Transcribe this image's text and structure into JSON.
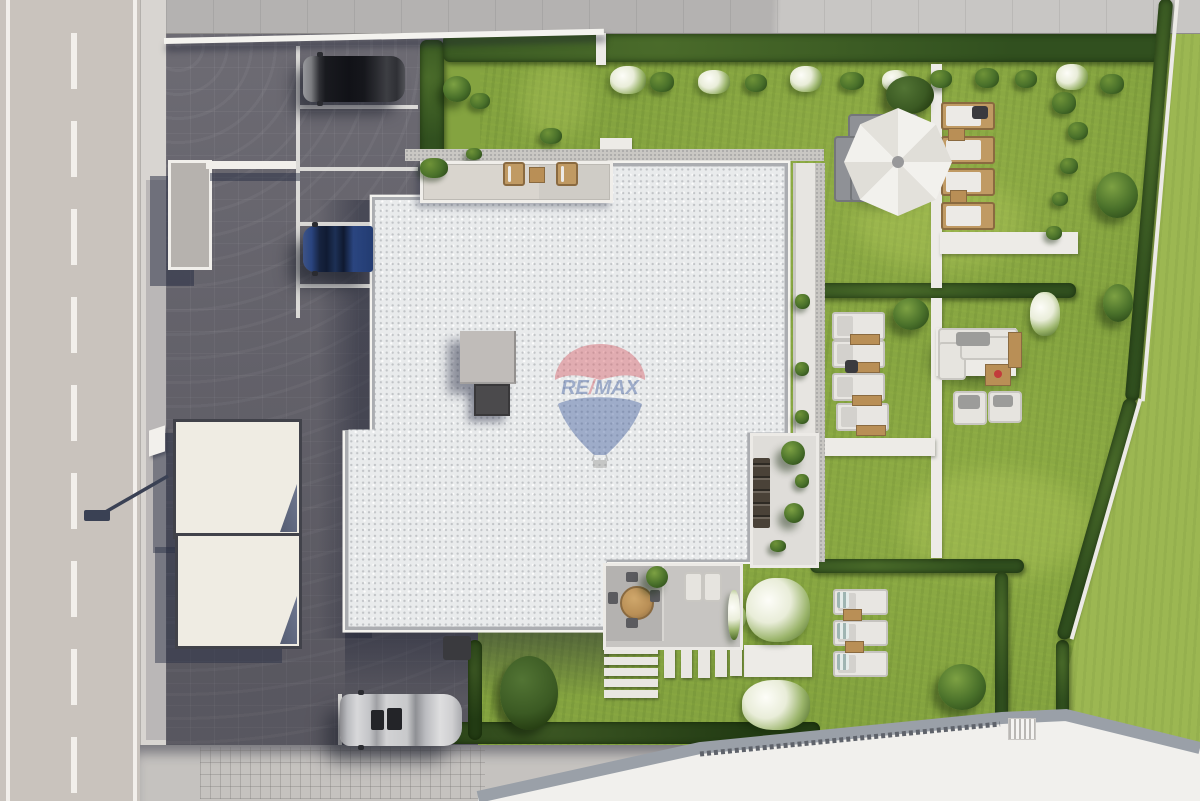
{
  "logo": {
    "re": "RE",
    "slash": "/",
    "max": "MAX"
  },
  "palette": {
    "grass": "#84a340",
    "grassLight": "#9cb752",
    "road": "#c9c3bd",
    "line": "#f2efeb",
    "sidewalk": "#d8d5d1",
    "paver": "#74727a",
    "roofWhite": "#e9ebec",
    "roofBorder": "#abadb1",
    "roofRail": "#f4f3ef",
    "hedge": "#31501f",
    "tree": "#49702a",
    "path": "#edebe7",
    "wood": "#b98f56",
    "woodLight": "#c09a63",
    "furnWhite": "#e8e6e2",
    "sofaGray": "#8f9196",
    "logoRed": "#d9626b",
    "logoBlue": "#44609f",
    "carDark": "#1a1b20",
    "carBlue": "#27477f",
    "carSilver": "#c9c9cc"
  },
  "scene": {
    "ground": [
      {
        "t": "road-dash",
        "x": 71,
        "y": 33,
        "w": 6,
        "h": 56
      },
      {
        "t": "road-dash",
        "x": 71,
        "y": 121,
        "w": 6,
        "h": 56
      },
      {
        "t": "road-dash",
        "x": 71,
        "y": 209,
        "w": 6,
        "h": 56
      },
      {
        "t": "road-dash",
        "x": 71,
        "y": 297,
        "w": 6,
        "h": 56
      },
      {
        "t": "road-dash",
        "x": 71,
        "y": 385,
        "w": 6,
        "h": 56
      },
      {
        "t": "road-dash",
        "x": 71,
        "y": 473,
        "w": 6,
        "h": 56
      },
      {
        "t": "road-dash",
        "x": 71,
        "y": 561,
        "w": 6,
        "h": 56
      },
      {
        "t": "road-dash",
        "x": 71,
        "y": 649,
        "w": 6,
        "h": 56
      },
      {
        "t": "road-dash",
        "x": 71,
        "y": 737,
        "w": 6,
        "h": 56
      },
      {
        "t": "pline",
        "x": 296,
        "y": 46,
        "w": 4,
        "h": 272
      },
      {
        "t": "pline",
        "x": 300,
        "y": 105,
        "w": 118,
        "h": 4
      },
      {
        "t": "pline",
        "x": 300,
        "y": 167,
        "w": 118,
        "h": 4
      },
      {
        "t": "pline",
        "x": 300,
        "y": 222,
        "w": 118,
        "h": 4
      },
      {
        "t": "pline",
        "x": 300,
        "y": 284,
        "w": 118,
        "h": 4
      },
      {
        "t": "pline",
        "x": 338,
        "y": 694,
        "w": 4,
        "h": 60
      },
      {
        "t": "pline",
        "x": 342,
        "y": 752,
        "w": 118,
        "h": 4
      },
      {
        "t": "grass-patch",
        "x": 444,
        "y": 33,
        "w": 36,
        "h": 128
      },
      {
        "t": "grass-light",
        "x": 855,
        "y": 175,
        "w": 170,
        "h": 95
      },
      {
        "t": "grass-light",
        "x": 900,
        "y": 470,
        "w": 190,
        "h": 110
      },
      {
        "t": "grass-light",
        "x": 520,
        "y": 60,
        "w": 70,
        "h": 80
      },
      {
        "t": "shade",
        "x": 844,
        "y": 140,
        "w": 86,
        "h": 68
      },
      {
        "t": "shade",
        "x": 930,
        "y": 336,
        "w": 90,
        "h": 50
      },
      {
        "t": "hedge",
        "x": 420,
        "y": 40,
        "w": 24,
        "h": 124
      },
      {
        "t": "hedge",
        "x": 443,
        "y": 34,
        "w": 720,
        "h": 28
      },
      {
        "t": "hedge",
        "x": 813,
        "y": 283,
        "w": 263,
        "h": 15
      },
      {
        "t": "hedge",
        "x": 810,
        "y": 559,
        "w": 214,
        "h": 14
      },
      {
        "t": "hedge",
        "x": 995,
        "y": 572,
        "w": 13,
        "h": 147
      },
      {
        "t": "hedge",
        "x": 1056,
        "y": 640,
        "w": 13,
        "h": 77
      },
      {
        "t": "hedge",
        "x": 1142,
        "y": -2,
        "w": 14,
        "h": 404,
        "r": 4.9
      },
      {
        "t": "hedge",
        "x": 1090,
        "y": 394,
        "w": 14,
        "h": 250,
        "r": 16
      },
      {
        "t": "hedge2",
        "x": 440,
        "y": 722,
        "w": 380,
        "h": 22
      },
      {
        "t": "hedge2",
        "x": 468,
        "y": 640,
        "w": 14,
        "h": 100
      },
      {
        "t": "edge",
        "x": 1158,
        "y": -2,
        "w": 4,
        "h": 404,
        "r": 4.9
      },
      {
        "t": "edge",
        "x": 1104,
        "y": 394,
        "w": 4,
        "h": 250,
        "r": 16
      },
      {
        "t": "path",
        "x": 931,
        "y": 64,
        "w": 11,
        "h": 224
      },
      {
        "t": "path",
        "x": 931,
        "y": 298,
        "w": 11,
        "h": 260
      },
      {
        "t": "path",
        "x": 813,
        "y": 438,
        "w": 122,
        "h": 18
      },
      {
        "t": "path",
        "x": 940,
        "y": 232,
        "w": 138,
        "h": 22
      },
      {
        "t": "path",
        "x": 744,
        "y": 645,
        "w": 68,
        "h": 32
      },
      {
        "t": "path",
        "x": 596,
        "y": 33,
        "w": 10,
        "h": 32
      },
      {
        "t": "path",
        "x": 600,
        "y": 138,
        "w": 32,
        "h": 13
      },
      {
        "t": "step",
        "x": 604,
        "y": 646,
        "w": 54,
        "h": 8
      },
      {
        "t": "step",
        "x": 604,
        "y": 657,
        "w": 54,
        "h": 8
      },
      {
        "t": "step",
        "x": 604,
        "y": 668,
        "w": 54,
        "h": 8
      },
      {
        "t": "step",
        "x": 604,
        "y": 679,
        "w": 54,
        "h": 8
      },
      {
        "t": "step",
        "x": 604,
        "y": 690,
        "w": 54,
        "h": 8
      },
      {
        "t": "step",
        "x": 664,
        "y": 648,
        "w": 11,
        "h": 30
      },
      {
        "t": "step",
        "x": 681,
        "y": 648,
        "w": 11,
        "h": 30
      },
      {
        "t": "step",
        "x": 698,
        "y": 648,
        "w": 12,
        "h": 30
      },
      {
        "t": "step",
        "x": 715,
        "y": 647,
        "w": 12,
        "h": 30
      },
      {
        "t": "step",
        "x": 730,
        "y": 646,
        "w": 12,
        "h": 30
      },
      {
        "t": "gravel",
        "x": 405,
        "y": 149,
        "w": 419,
        "h": 12
      },
      {
        "t": "flower",
        "x": 610,
        "y": 66,
        "w": 36,
        "h": 28
      },
      {
        "t": "flower",
        "x": 698,
        "y": 70,
        "w": 32,
        "h": 24
      },
      {
        "t": "flower",
        "x": 790,
        "y": 66,
        "w": 32,
        "h": 26
      },
      {
        "t": "flower",
        "x": 882,
        "y": 70,
        "w": 28,
        "h": 22
      },
      {
        "t": "flower",
        "x": 1056,
        "y": 64,
        "w": 32,
        "h": 26
      },
      {
        "t": "flower",
        "x": 1030,
        "y": 292,
        "w": 30,
        "h": 44
      },
      {
        "t": "flower",
        "x": 746,
        "y": 578,
        "w": 64,
        "h": 64
      },
      {
        "t": "flower",
        "x": 742,
        "y": 680,
        "w": 68,
        "h": 50
      },
      {
        "t": "flower",
        "x": 712,
        "y": 602,
        "w": 34,
        "h": 30
      },
      {
        "t": "bush",
        "x": 650,
        "y": 72,
        "w": 24,
        "h": 20
      },
      {
        "t": "bush",
        "x": 745,
        "y": 74,
        "w": 22,
        "h": 18
      },
      {
        "t": "bush",
        "x": 840,
        "y": 72,
        "w": 24,
        "h": 18
      },
      {
        "t": "bush",
        "x": 930,
        "y": 70,
        "w": 22,
        "h": 18
      },
      {
        "t": "bush",
        "x": 975,
        "y": 68,
        "w": 24,
        "h": 20
      },
      {
        "t": "bush",
        "x": 1015,
        "y": 70,
        "w": 22,
        "h": 18
      },
      {
        "t": "bush",
        "x": 1100,
        "y": 74,
        "w": 24,
        "h": 20
      },
      {
        "t": "bush",
        "x": 1052,
        "y": 92,
        "w": 24,
        "h": 22
      },
      {
        "t": "bush",
        "x": 1068,
        "y": 122,
        "w": 20,
        "h": 18
      },
      {
        "t": "bush",
        "x": 1060,
        "y": 158,
        "w": 18,
        "h": 16
      },
      {
        "t": "bush",
        "x": 1052,
        "y": 192,
        "w": 16,
        "h": 14
      },
      {
        "t": "bush",
        "x": 1046,
        "y": 226,
        "w": 16,
        "h": 14
      },
      {
        "t": "bush",
        "x": 470,
        "y": 93,
        "w": 20,
        "h": 16
      },
      {
        "t": "bush",
        "x": 540,
        "y": 128,
        "w": 22,
        "h": 16
      },
      {
        "t": "bush",
        "x": 466,
        "y": 148,
        "w": 16,
        "h": 12
      },
      {
        "t": "tree",
        "x": 443,
        "y": 76,
        "w": 28,
        "h": 26
      },
      {
        "t": "tree",
        "x": 893,
        "y": 298,
        "w": 36,
        "h": 32
      },
      {
        "t": "tree",
        "x": 1096,
        "y": 172,
        "w": 42,
        "h": 46
      },
      {
        "t": "tree",
        "x": 1103,
        "y": 284,
        "w": 30,
        "h": 38
      },
      {
        "t": "tree",
        "x": 938,
        "y": 664,
        "w": 48,
        "h": 46
      },
      {
        "t": "tree-dark",
        "x": 886,
        "y": 76,
        "w": 48,
        "h": 38
      },
      {
        "t": "tree-dark",
        "x": 500,
        "y": 656,
        "w": 58,
        "h": 74
      },
      {
        "t": "lg-wood",
        "x": 941,
        "y": 102,
        "w": 50,
        "h": 24
      },
      {
        "t": "lg-wood",
        "x": 941,
        "y": 136,
        "w": 50,
        "h": 24
      },
      {
        "t": "lg-wood",
        "x": 941,
        "y": 168,
        "w": 50,
        "h": 24
      },
      {
        "t": "lg-wood",
        "x": 941,
        "y": 202,
        "w": 50,
        "h": 24
      },
      {
        "t": "tbl-wood",
        "x": 948,
        "y": 128,
        "w": 15,
        "h": 11
      },
      {
        "t": "tbl-wood",
        "x": 950,
        "y": 190,
        "w": 15,
        "h": 11
      },
      {
        "t": "dark",
        "x": 972,
        "y": 106,
        "w": 16,
        "h": 13
      },
      {
        "t": "lg-white",
        "x": 832,
        "y": 312,
        "w": 49,
        "h": 24
      },
      {
        "t": "lg-white",
        "x": 832,
        "y": 340,
        "w": 49,
        "h": 24
      },
      {
        "t": "lg-white",
        "x": 832,
        "y": 373,
        "w": 49,
        "h": 24
      },
      {
        "t": "lg-white",
        "x": 836,
        "y": 403,
        "w": 49,
        "h": 24
      },
      {
        "t": "lg-white",
        "x": 833,
        "y": 589,
        "w": 51,
        "h": 22
      },
      {
        "t": "lg-white",
        "x": 833,
        "y": 620,
        "w": 51,
        "h": 22
      },
      {
        "t": "lg-white",
        "x": 833,
        "y": 651,
        "w": 51,
        "h": 22
      },
      {
        "t": "tbl-wood",
        "x": 850,
        "y": 334,
        "w": 28,
        "h": 9
      },
      {
        "t": "tbl-wood",
        "x": 850,
        "y": 362,
        "w": 28,
        "h": 9
      },
      {
        "t": "tbl-wood",
        "x": 852,
        "y": 395,
        "w": 28,
        "h": 9
      },
      {
        "t": "tbl-wood",
        "x": 856,
        "y": 425,
        "w": 28,
        "h": 9
      },
      {
        "t": "tbl-wood",
        "x": 843,
        "y": 609,
        "w": 17,
        "h": 10
      },
      {
        "t": "tbl-wood",
        "x": 845,
        "y": 641,
        "w": 17,
        "h": 10
      },
      {
        "t": "dark",
        "x": 845,
        "y": 360,
        "w": 13,
        "h": 13
      },
      {
        "t": "towel",
        "x": 837,
        "y": 592,
        "w": 12,
        "h": 16
      },
      {
        "t": "towel",
        "x": 837,
        "y": 623,
        "w": 12,
        "h": 16
      },
      {
        "t": "towel",
        "x": 837,
        "y": 654,
        "w": 12,
        "h": 16
      },
      {
        "t": "sofa-gray",
        "x": 848,
        "y": 114,
        "w": 66,
        "h": 28
      },
      {
        "t": "sofa-gray",
        "x": 834,
        "y": 136,
        "w": 28,
        "h": 62
      },
      {
        "t": "sofa-gray",
        "x": 850,
        "y": 170,
        "w": 54,
        "h": 28
      },
      {
        "t": "dark",
        "x": 876,
        "y": 132,
        "w": 20,
        "h": 16
      },
      {
        "t": "path",
        "x": 936,
        "y": 328,
        "w": 80,
        "h": 48
      },
      {
        "t": "sofa-white",
        "x": 938,
        "y": 328,
        "w": 76,
        "h": 16
      },
      {
        "t": "sofa-white",
        "x": 938,
        "y": 342,
        "w": 24,
        "h": 34
      },
      {
        "t": "sofa-white",
        "x": 960,
        "y": 336,
        "w": 54,
        "h": 20
      },
      {
        "t": "sofa-white",
        "x": 953,
        "y": 391,
        "w": 30,
        "h": 30
      },
      {
        "t": "sofa-white",
        "x": 988,
        "y": 391,
        "w": 30,
        "h": 28
      },
      {
        "t": "pillow-gray",
        "x": 956,
        "y": 332,
        "w": 34,
        "h": 14
      },
      {
        "t": "pillow-gray",
        "x": 958,
        "y": 395,
        "w": 22,
        "h": 14
      },
      {
        "t": "pillow-gray",
        "x": 993,
        "y": 395,
        "w": 20,
        "h": 12
      },
      {
        "t": "tbl-wood",
        "x": 985,
        "y": 364,
        "w": 24,
        "h": 20
      },
      {
        "t": "tbl-wood",
        "x": 1008,
        "y": 332,
        "w": 12,
        "h": 34
      },
      {
        "t": "dot-red",
        "x": 994,
        "y": 370,
        "w": 8,
        "h": 8
      },
      {
        "t": "umbrella",
        "x": 844,
        "y": 108,
        "w": 108,
        "h": 108
      },
      {
        "t": "tick",
        "x": 390,
        "y": 622,
        "w": 10,
        "h": 5
      },
      {
        "t": "tick",
        "x": 452,
        "y": 622,
        "w": 10,
        "h": 5
      },
      {
        "t": "tick",
        "x": 540,
        "y": 622,
        "w": 10,
        "h": 5
      },
      {
        "t": "tick",
        "x": 582,
        "y": 622,
        "w": 10,
        "h": 5
      },
      {
        "t": "dark",
        "x": 443,
        "y": 636,
        "w": 28,
        "h": 24
      }
    ],
    "upper": [
      {
        "t": "lg-wood",
        "x": 503,
        "y": 162,
        "w": 18,
        "h": 20
      },
      {
        "t": "lg-wood",
        "x": 556,
        "y": 162,
        "w": 18,
        "h": 20
      },
      {
        "t": "tbl-wood",
        "x": 529,
        "y": 167,
        "w": 14,
        "h": 14
      },
      {
        "t": "bush",
        "x": 420,
        "y": 158,
        "w": 28,
        "h": 20
      },
      {
        "t": "bush",
        "x": 795,
        "y": 294,
        "w": 15,
        "h": 15
      },
      {
        "t": "bush",
        "x": 795,
        "y": 362,
        "w": 14,
        "h": 14
      },
      {
        "t": "bush",
        "x": 795,
        "y": 410,
        "w": 14,
        "h": 14
      },
      {
        "t": "bush",
        "x": 795,
        "y": 474,
        "w": 14,
        "h": 14
      },
      {
        "t": "bush",
        "x": 770,
        "y": 540,
        "w": 16,
        "h": 12
      },
      {
        "t": "tree",
        "x": 781,
        "y": 441,
        "w": 24,
        "h": 24
      },
      {
        "t": "tree",
        "x": 784,
        "y": 503,
        "w": 20,
        "h": 20
      },
      {
        "t": "dark-chairs",
        "x": 753,
        "y": 458,
        "w": 17,
        "h": 70
      },
      {
        "t": "grate",
        "x": 1008,
        "y": 718,
        "w": 26,
        "h": 20
      }
    ]
  }
}
